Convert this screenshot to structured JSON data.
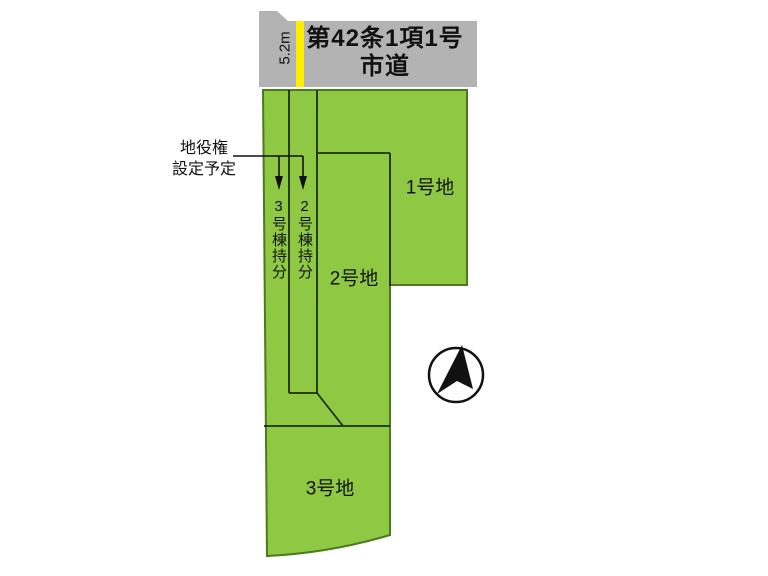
{
  "diagram": {
    "title": "land-subdivision-plan",
    "road": {
      "label_line1": "第42条1項1号",
      "label_line2": "市道",
      "width_label": "5.2m"
    },
    "parcels": [
      {
        "label": "1号地"
      },
      {
        "label": "2号地"
      },
      {
        "label": "3号地"
      }
    ],
    "strips": {
      "strip3_label": "3号棟持分",
      "strip2_label": "2号棟持分"
    },
    "annotation": {
      "line1": "地役権",
      "line2": "設定予定"
    },
    "icons": {
      "north_arrow": "north-arrow-compass"
    },
    "colors": {
      "parcel_green": "#8fc843",
      "parcel_border": "#4c7a1d",
      "road_gray": "#b3b3b3",
      "highlight_yellow": "#ffee00",
      "line_dark": "#1b2e08",
      "ink": "#111111"
    }
  }
}
